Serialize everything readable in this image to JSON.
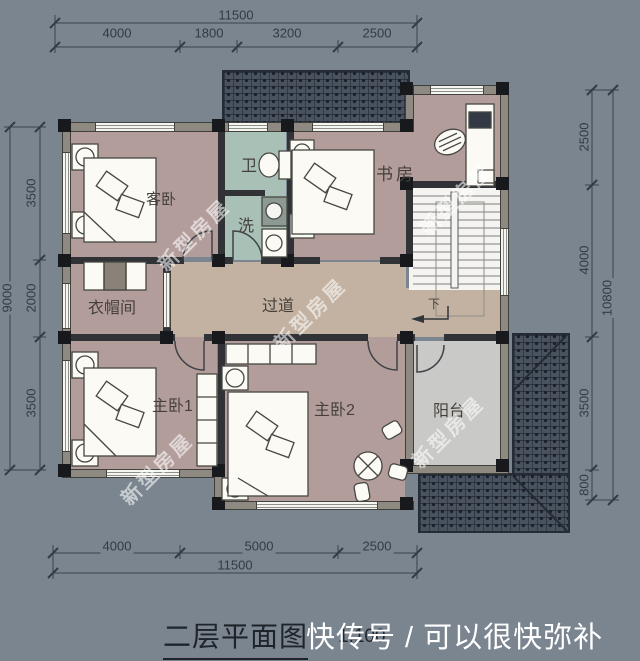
{
  "plan": {
    "rooms": {
      "guest_bedroom": "客卧",
      "bath": "卫",
      "wash": "洗",
      "study": "书房",
      "cloakroom": "衣帽间",
      "corridor": "过道",
      "master_bedroom_1": "主卧1",
      "master_bedroom_2": "主卧2",
      "balcony": "阳台",
      "stairs_down_label": "下"
    },
    "colors": {
      "background": "#7a8590",
      "floor": "#b29d9b",
      "bath_floor": "#a9c0b6",
      "corridor_floor": "#c3b2a1",
      "balcony_floor": "#c9cac7",
      "stair_floor": "#f5f4f0",
      "roof": "#49525f",
      "structure": "#17191d"
    }
  },
  "dimensions": {
    "top": {
      "total": "11500",
      "segments": [
        "4000",
        "1800",
        "3200",
        "2500"
      ]
    },
    "bottom": {
      "total": "11500",
      "segments": [
        "4000",
        "5000",
        "2500"
      ]
    },
    "left": {
      "total": "9000",
      "segments": [
        "3500",
        "2000",
        "3500"
      ]
    },
    "right": {
      "total": "10800",
      "segments": [
        "2500",
        "4000",
        "3500",
        "800"
      ]
    }
  },
  "footer": {
    "title": "二层平面图",
    "scale": "1:100",
    "watermark": "快传号 / 可以很快弥补"
  },
  "watermark": {
    "text": "新型房屋"
  }
}
